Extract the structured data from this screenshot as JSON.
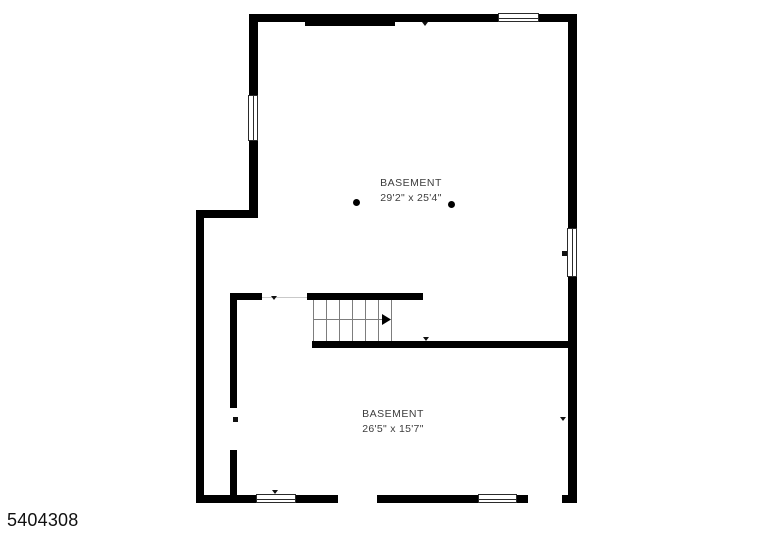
{
  "page": {
    "id_label": "5404308",
    "background_color": "#ffffff",
    "wall_color": "#000000",
    "label_text_color": "#3d3d3d",
    "tread_color": "#7d7d7d",
    "door_line_color": "#c9c9c9"
  },
  "rooms": [
    {
      "name": "BASEMENT",
      "dimensions": "29'2\" x 25'4\"",
      "label_x": 411,
      "label_y": 177
    },
    {
      "name": "BASEMENT",
      "dimensions": "26'5\" x 15'7\"",
      "label_x": 393,
      "label_y": 408
    }
  ],
  "floorplan": {
    "walls": [
      {
        "x": 250,
        "y": 14,
        "w": 326,
        "h": 8
      },
      {
        "x": 305,
        "y": 14,
        "w": 90,
        "h": 12
      },
      {
        "x": 568,
        "y": 14,
        "w": 9,
        "h": 489
      },
      {
        "x": 562,
        "y": 495,
        "w": 14,
        "h": 8
      },
      {
        "x": 249,
        "y": 14,
        "w": 9,
        "h": 204
      },
      {
        "x": 196,
        "y": 210,
        "w": 62,
        "h": 8
      },
      {
        "x": 196,
        "y": 210,
        "w": 8,
        "h": 293
      },
      {
        "x": 196,
        "y": 495,
        "w": 142,
        "h": 8
      },
      {
        "x": 377,
        "y": 495,
        "w": 151,
        "h": 8
      },
      {
        "x": 230,
        "y": 293,
        "w": 32,
        "h": 7
      },
      {
        "x": 230,
        "y": 293,
        "w": 7,
        "h": 115
      },
      {
        "x": 230,
        "y": 450,
        "w": 7,
        "h": 53
      },
      {
        "x": 307,
        "y": 293,
        "w": 116,
        "h": 7
      },
      {
        "x": 312,
        "y": 341,
        "w": 260,
        "h": 7
      }
    ],
    "windows": [
      {
        "x": 498,
        "y": 13,
        "w": 41,
        "h": 9,
        "o": "h"
      },
      {
        "x": 248,
        "y": 95,
        "w": 10,
        "h": 46,
        "o": "v"
      },
      {
        "x": 567,
        "y": 228,
        "w": 10,
        "h": 49,
        "o": "v"
      },
      {
        "x": 256,
        "y": 494,
        "w": 40,
        "h": 9,
        "o": "h"
      },
      {
        "x": 478,
        "y": 494,
        "w": 39,
        "h": 9,
        "o": "h"
      }
    ],
    "stairs": {
      "treads_x": [
        313,
        326,
        339,
        352,
        365,
        378,
        391
      ],
      "tread_top": 300,
      "tread_bottom": 341,
      "arrow_line": {
        "x1": 313,
        "x2": 382,
        "y": 319
      },
      "arrow_head": {
        "x": 382,
        "y": 314,
        "w": 9,
        "h": 11
      }
    },
    "door_lines": [
      {
        "x1": 262,
        "x2": 307,
        "y": 297
      }
    ],
    "tick_markers": [
      {
        "x": 422,
        "y": 22,
        "w": 6,
        "h": 4
      },
      {
        "x": 271,
        "y": 296,
        "w": 6,
        "h": 4
      },
      {
        "x": 423,
        "y": 337,
        "w": 6,
        "h": 4
      },
      {
        "x": 560,
        "y": 417,
        "w": 6,
        "h": 4
      },
      {
        "x": 272,
        "y": 490,
        "w": 6,
        "h": 4
      }
    ],
    "square_markers": [
      {
        "x": 233,
        "y": 417,
        "w": 5,
        "h": 5
      },
      {
        "x": 562,
        "y": 251,
        "w": 5,
        "h": 5
      }
    ],
    "support_columns": [
      {
        "cx": 356,
        "cy": 202,
        "r": 3.5
      },
      {
        "cx": 451,
        "cy": 204,
        "r": 3.5
      }
    ]
  }
}
